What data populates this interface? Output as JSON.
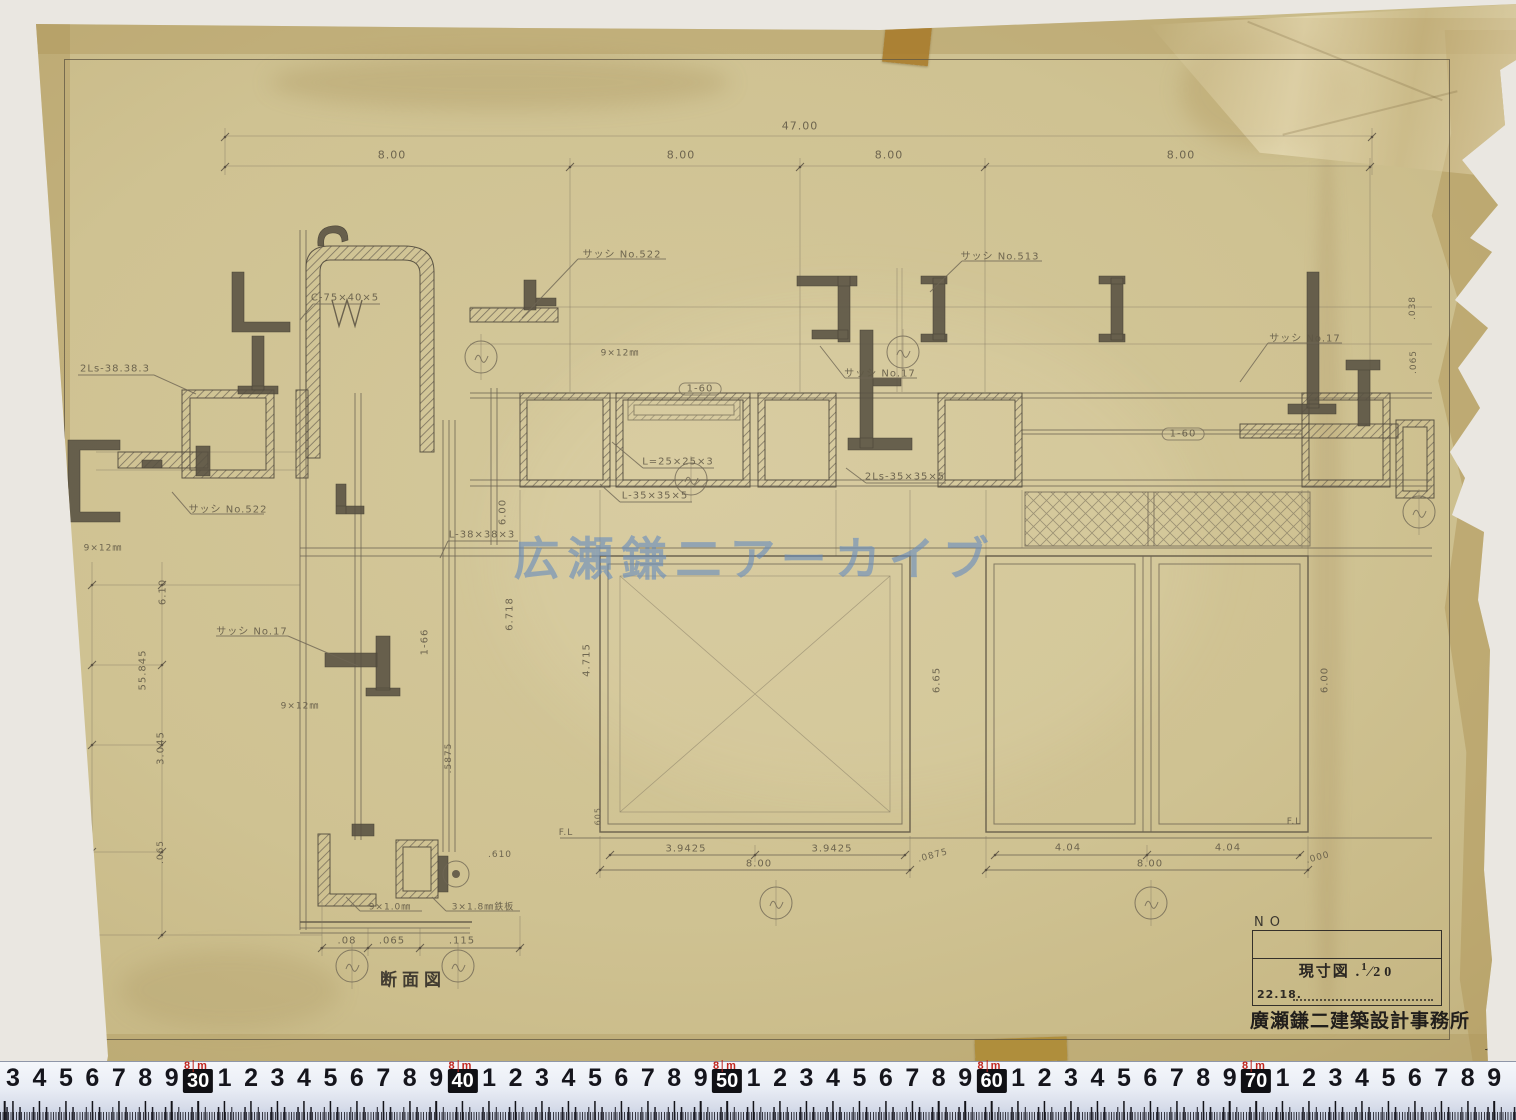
{
  "colors": {
    "paper": "#cfc292",
    "tape": "#a87c2c",
    "pencil": "#6b6353",
    "watermark_blue": "#648ac0",
    "ruler_red": "#c1271f",
    "stamp_ink": "#211e1b"
  },
  "sheet": {
    "watermark": "広瀬鎌二アーカイブ"
  },
  "title_block": {
    "no_label": "NO",
    "scale_label": "現寸図 .",
    "scale_numerator": "1",
    "scale_denominator": "20",
    "date": "22.18.",
    "office_name": "廣瀬鎌二建築設計事務所"
  },
  "drawing_title": "断面図",
  "annotations": [
    {
      "text": "47.00",
      "x": 800,
      "y": 126,
      "size": 11
    },
    {
      "text": "8.00",
      "x": 392,
      "y": 155,
      "size": 11
    },
    {
      "text": "8.00",
      "x": 681,
      "y": 155,
      "size": 11
    },
    {
      "text": "8.00",
      "x": 889,
      "y": 155,
      "size": 11
    },
    {
      "text": "8.00",
      "x": 1181,
      "y": 155,
      "size": 11
    },
    {
      "text": "サッシ No.522",
      "x": 622,
      "y": 253,
      "size": 10
    },
    {
      "text": "サッシ No.513",
      "x": 1000,
      "y": 255,
      "size": 10
    },
    {
      "text": "サッシ No.17",
      "x": 880,
      "y": 372,
      "size": 10
    },
    {
      "text": "サッシ No.17",
      "x": 1305,
      "y": 337,
      "size": 10
    },
    {
      "text": "サッシ No.17",
      "x": 252,
      "y": 630,
      "size": 10
    },
    {
      "text": "サッシ No.522",
      "x": 228,
      "y": 508,
      "size": 10
    },
    {
      "text": "2Ls-38.38.3",
      "x": 115,
      "y": 369,
      "size": 10
    },
    {
      "text": "C-75×40×5",
      "x": 345,
      "y": 298,
      "size": 10
    },
    {
      "text": "L=25×25×3",
      "x": 678,
      "y": 462,
      "size": 10
    },
    {
      "text": "L-35×35×5",
      "x": 655,
      "y": 496,
      "size": 10
    },
    {
      "text": "2Ls-35×35×5",
      "x": 905,
      "y": 477,
      "size": 10
    },
    {
      "text": "L-38×38×3",
      "x": 482,
      "y": 535,
      "size": 10
    },
    {
      "text": "1-60",
      "x": 700,
      "y": 389,
      "size": 10,
      "cls": "pill"
    },
    {
      "text": "1-60",
      "x": 1183,
      "y": 434,
      "size": 10,
      "cls": "pill"
    },
    {
      "text": "1-66",
      "x": 425,
      "y": 642,
      "rot": -90,
      "size": 10
    },
    {
      "text": "9×12㎜",
      "x": 620,
      "y": 352,
      "size": 9
    },
    {
      "text": "9×12㎜",
      "x": 103,
      "y": 547,
      "size": 9
    },
    {
      "text": "9×12㎜",
      "x": 300,
      "y": 705,
      "size": 9
    },
    {
      "text": "9×1.0㎜",
      "x": 390,
      "y": 906,
      "size": 9
    },
    {
      "text": "3×1.8㎜鉄板",
      "x": 483,
      "y": 906,
      "size": 9
    },
    {
      "text": "6.00",
      "x": 503,
      "y": 512,
      "rot": -90,
      "size": 10
    },
    {
      "text": "6.718",
      "x": 510,
      "y": 614,
      "rot": -90,
      "size": 10
    },
    {
      "text": ".5875",
      "x": 449,
      "y": 758,
      "rot": -90,
      "size": 9
    },
    {
      "text": ".610",
      "x": 500,
      "y": 855,
      "size": 9
    },
    {
      "text": "4.715",
      "x": 587,
      "y": 660,
      "rot": -90,
      "size": 10
    },
    {
      "text": "6.65",
      "x": 937,
      "y": 680,
      "rot": -90,
      "size": 10
    },
    {
      "text": "6.00",
      "x": 1325,
      "y": 680,
      "rot": -90,
      "size": 10
    },
    {
      "text": "6.10",
      "x": 163,
      "y": 592,
      "rot": -90,
      "size": 10
    },
    {
      "text": "55.845",
      "x": 143,
      "y": 670,
      "rot": -90,
      "size": 10
    },
    {
      "text": "3.045",
      "x": 161,
      "y": 748,
      "rot": -90,
      "size": 10
    },
    {
      "text": ".065",
      "x": 161,
      "y": 852,
      "rot": -90,
      "size": 9
    },
    {
      "text": ".605",
      "x": 598,
      "y": 818,
      "rot": -90,
      "size": 8
    },
    {
      "text": ".038",
      "x": 1413,
      "y": 308,
      "rot": -90,
      "size": 9
    },
    {
      "text": ".065",
      "x": 1414,
      "y": 362,
      "rot": -90,
      "size": 9
    },
    {
      "text": ".08",
      "x": 347,
      "y": 941,
      "size": 10
    },
    {
      "text": ".065",
      "x": 392,
      "y": 941,
      "size": 10
    },
    {
      "text": ".115",
      "x": 462,
      "y": 941,
      "size": 10
    },
    {
      "text": "3.9425",
      "x": 686,
      "y": 849,
      "size": 10
    },
    {
      "text": "3.9425",
      "x": 832,
      "y": 849,
      "size": 10
    },
    {
      "text": "8.00",
      "x": 759,
      "y": 864,
      "size": 10
    },
    {
      "text": ".0875",
      "x": 933,
      "y": 856,
      "rot": -15,
      "size": 9
    },
    {
      "text": "4.04",
      "x": 1068,
      "y": 848,
      "size": 10
    },
    {
      "text": "4.04",
      "x": 1228,
      "y": 848,
      "size": 10
    },
    {
      "text": "8.00",
      "x": 1150,
      "y": 864,
      "size": 10
    },
    {
      "text": ".000",
      "x": 1318,
      "y": 858,
      "rot": -15,
      "size": 9
    },
    {
      "text": "F.L",
      "x": 566,
      "y": 833,
      "size": 9
    },
    {
      "text": "F.L",
      "x": 1294,
      "y": 822,
      "size": 9
    },
    {
      "text": "断面図",
      "x": 413,
      "y": 978,
      "size": 17,
      "cls": "dark"
    },
    {
      "text": "1",
      "x": 1489,
      "y": 1047,
      "size": 15,
      "rot": 12,
      "cls": "ink"
    }
  ],
  "ruler": {
    "leading_digits": [
      "3",
      "4",
      "5",
      "6",
      "7",
      "8",
      "9"
    ],
    "decade_boxes": [
      "30",
      "40",
      "50",
      "60",
      "70"
    ],
    "digits_per_decade": [
      "1",
      "2",
      "3",
      "4",
      "5",
      "6",
      "7",
      "8",
      "9"
    ],
    "meter_label_number": "8",
    "meter_label_unit": "m",
    "start_x": 13,
    "step": 26.45
  }
}
